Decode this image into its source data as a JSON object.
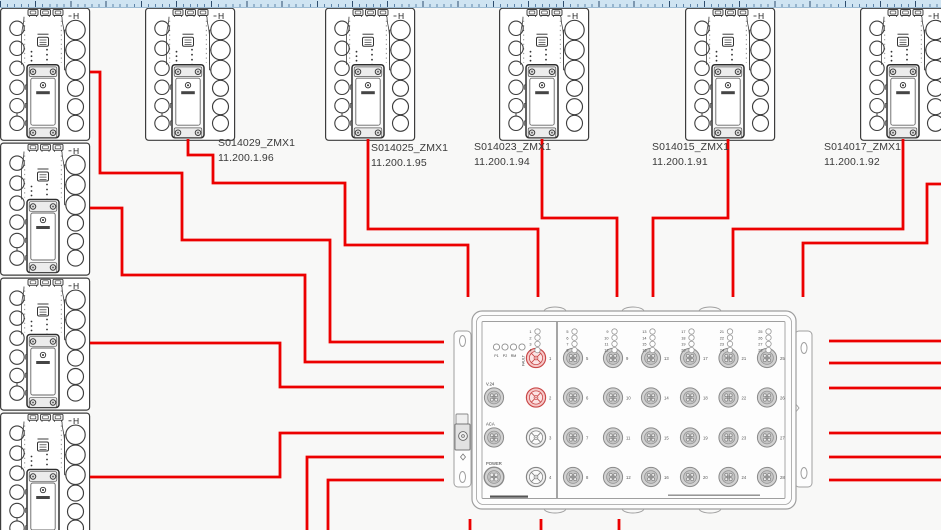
{
  "colors": {
    "background": "#f8f8f7",
    "wire": "#ec0000",
    "module_stroke": "#3d3d3d",
    "switch_stroke": "#9f9f9f",
    "port_red_stroke": "#c94848",
    "port_red_fill": "#f6c9c9",
    "port_gray_fill": "#d2d2d2",
    "label_text": "#3a3a3a"
  },
  "devices": {
    "module_h_label": "H",
    "labels": [
      {
        "name": "S014029_ZMX1",
        "ip": "11.200.1.96"
      },
      {
        "name": "S014025_ZMX1",
        "ip": "11.200.1.95"
      },
      {
        "name": "S014023_ZMX1",
        "ip": "11.200.1.94"
      },
      {
        "name": "S014015_ZMX1",
        "ip": "11.200.1.91"
      },
      {
        "name": "S014017_ZMX1",
        "ip": "11.200.1.92"
      }
    ],
    "label_positions": [
      {
        "x": 218,
        "y": 136
      },
      {
        "x": 371,
        "y": 141
      },
      {
        "x": 474,
        "y": 140
      },
      {
        "x": 652,
        "y": 140
      },
      {
        "x": 824,
        "y": 140
      }
    ],
    "top_row": {
      "y": 7.7,
      "xs": [
        145,
        325,
        499,
        685,
        860
      ]
    },
    "left_column": {
      "x": 0,
      "ys": [
        7.7,
        142.5,
        277.5,
        412.5
      ]
    }
  },
  "switch": {
    "status_leds": [
      "P1",
      "P2",
      "RM",
      "FAULT"
    ],
    "side_ports": [
      "V.24",
      "ACA",
      "POWER"
    ],
    "port_count": 28,
    "highlighted_ports": [
      1,
      2
    ],
    "body": {
      "x": 472,
      "y": 311,
      "w": 324,
      "h": 198
    },
    "port_cols_x": [
      536,
      573,
      613,
      651,
      690,
      728.5,
      767
    ],
    "port_rows_y": [
      358,
      397.5,
      437.5,
      477
    ]
  },
  "wires": [
    [
      [
        90,
        72
      ],
      [
        100,
        72
      ],
      [
        100,
        173
      ],
      [
        182,
        173
      ],
      [
        182,
        240
      ],
      [
        330,
        240
      ],
      [
        330,
        342
      ],
      [
        444,
        342
      ]
    ],
    [
      [
        90,
        208
      ],
      [
        122,
        208
      ],
      [
        122,
        275
      ],
      [
        305,
        275
      ],
      [
        305,
        362
      ],
      [
        444,
        362
      ]
    ],
    [
      [
        90,
        343
      ],
      [
        280,
        343
      ],
      [
        280,
        387
      ],
      [
        444,
        387
      ]
    ],
    [
      [
        90,
        477
      ],
      [
        280,
        477
      ],
      [
        280,
        433
      ],
      [
        444,
        433
      ]
    ],
    [
      [
        307,
        530
      ],
      [
        307,
        457
      ],
      [
        444,
        457
      ]
    ],
    [
      [
        328,
        530
      ],
      [
        328,
        480
      ],
      [
        444,
        480
      ]
    ],
    [
      [
        188,
        139
      ],
      [
        188,
        155
      ],
      [
        213,
        155
      ],
      [
        213,
        183
      ],
      [
        345,
        183
      ],
      [
        345,
        245
      ],
      [
        468,
        245
      ],
      [
        468,
        297
      ]
    ],
    [
      [
        368,
        139
      ],
      [
        368,
        229
      ],
      [
        538,
        229
      ],
      [
        538,
        297
      ]
    ],
    [
      [
        542,
        139
      ],
      [
        542,
        218
      ],
      [
        617,
        218
      ],
      [
        617,
        297
      ]
    ],
    [
      [
        728,
        139
      ],
      [
        728,
        218
      ],
      [
        653,
        218
      ],
      [
        653,
        297
      ]
    ],
    [
      [
        903,
        139
      ],
      [
        903,
        229
      ],
      [
        733,
        229
      ],
      [
        733,
        297
      ]
    ],
    [
      [
        941,
        184
      ],
      [
        927,
        184
      ],
      [
        927,
        243
      ],
      [
        803,
        243
      ],
      [
        803,
        297
      ]
    ],
    [
      [
        829,
        341
      ],
      [
        941,
        341
      ]
    ],
    [
      [
        829,
        363
      ],
      [
        941,
        363
      ]
    ],
    [
      [
        829,
        388
      ],
      [
        941,
        388
      ]
    ],
    [
      [
        829,
        433
      ],
      [
        941,
        433
      ]
    ],
    [
      [
        829,
        457
      ],
      [
        941,
        457
      ]
    ],
    [
      [
        829,
        480
      ],
      [
        941,
        480
      ]
    ],
    [
      [
        470,
        519
      ],
      [
        470,
        530
      ]
    ],
    [
      [
        541,
        519
      ],
      [
        541,
        530
      ]
    ],
    [
      [
        619,
        519
      ],
      [
        619,
        530
      ]
    ]
  ]
}
